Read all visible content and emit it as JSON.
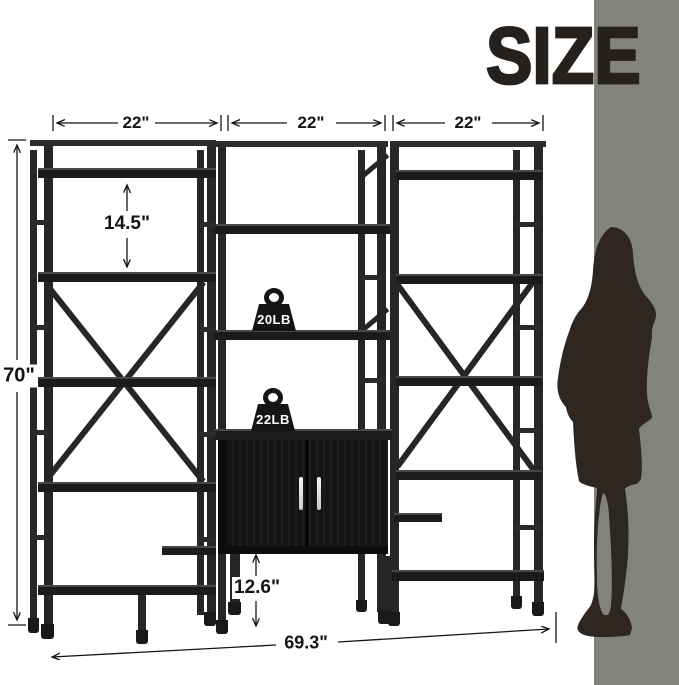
{
  "title": "SIZE",
  "dimensions": {
    "section_widths": [
      "22\"",
      "22\"",
      "22\""
    ],
    "shelf_spacing": "14.5\"",
    "overall_height": "70\"",
    "bottom_clearance": "12.6\"",
    "overall_width": "69.3\""
  },
  "weights": {
    "upper_shelf_capacity": "20LB",
    "cabinet_top_capacity": "22LB"
  },
  "colors": {
    "furniture": "#1f1f1f",
    "wall_panel": "#82827e",
    "silhouette": "#2e2620",
    "annotation": "#151515"
  }
}
